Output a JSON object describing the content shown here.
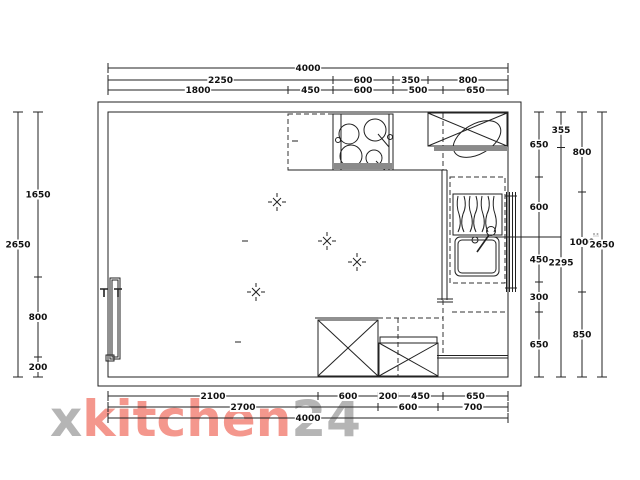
{
  "watermark": {
    "prefix": "x",
    "brand": "kitchen",
    "suffix": "24"
  },
  "colors": {
    "watermark_pink": "#f4978d",
    "watermark_gray": "#b5b5b5",
    "line": "#222222",
    "appliance_strip": "#8a8a8a"
  },
  "plan": {
    "room_width_mm": 4000,
    "room_height_mm": 2650
  },
  "dimensions": {
    "unit_scale_px_per_mm": 0.1,
    "origin": {
      "x": 108,
      "y": 112
    },
    "chains": [
      {
        "id": "top-total",
        "orientation": "horizontal",
        "line_px": 68,
        "segments_mm": [
          4000
        ],
        "labels": [
          "4000"
        ]
      },
      {
        "id": "top-middle",
        "orientation": "horizontal",
        "line_px": 80,
        "segments_mm": [
          2250,
          600,
          350,
          800
        ],
        "labels": [
          "2250",
          "600",
          "350",
          "800"
        ]
      },
      {
        "id": "top-inner",
        "orientation": "horizontal",
        "line_px": 90,
        "segments_mm": [
          1800,
          450,
          600,
          500,
          650
        ],
        "labels": [
          "1800",
          "450",
          "600",
          "500",
          "650"
        ]
      },
      {
        "id": "bottom-inner",
        "orientation": "horizontal",
        "line_px": 396,
        "segments_mm": [
          2100,
          600,
          200,
          450,
          650
        ],
        "labels": [
          "2100",
          "600",
          "200",
          "450",
          "650"
        ]
      },
      {
        "id": "bottom-middle",
        "orientation": "horizontal",
        "line_px": 407,
        "segments_mm": [
          2700,
          600,
          700
        ],
        "labels": [
          "2700",
          "600",
          "700"
        ]
      },
      {
        "id": "bottom-total",
        "orientation": "horizontal",
        "line_px": 418,
        "segments_mm": [
          4000
        ],
        "labels": [
          "4000"
        ]
      },
      {
        "id": "left-outer",
        "orientation": "vertical",
        "line_px": 18,
        "segments_mm": [
          2650
        ],
        "labels": [
          "2650"
        ]
      },
      {
        "id": "left-inner",
        "orientation": "vertical",
        "line_px": 38,
        "segments_mm": [
          1650,
          800,
          200
        ],
        "labels": [
          "1650",
          "800",
          "200"
        ]
      },
      {
        "id": "right-1",
        "orientation": "vertical",
        "line_px": 539,
        "segments_mm": [
          650,
          600,
          450,
          300,
          650
        ],
        "labels": [
          "650",
          "600",
          "450",
          "300",
          "650"
        ]
      },
      {
        "id": "right-2",
        "orientation": "vertical",
        "line_px": 561,
        "segments_mm": [
          355,
          2295
        ],
        "labels": [
          "355",
          "2295"
        ]
      },
      {
        "id": "right-3",
        "orientation": "vertical",
        "line_px": 582,
        "segments_mm": [
          800,
          1000,
          850
        ],
        "labels": [
          "800",
          "1000",
          "850"
        ]
      },
      {
        "id": "right-4",
        "orientation": "vertical",
        "line_px": 602,
        "segments_mm": [
          2650
        ],
        "labels": [
          "2650"
        ]
      }
    ]
  }
}
